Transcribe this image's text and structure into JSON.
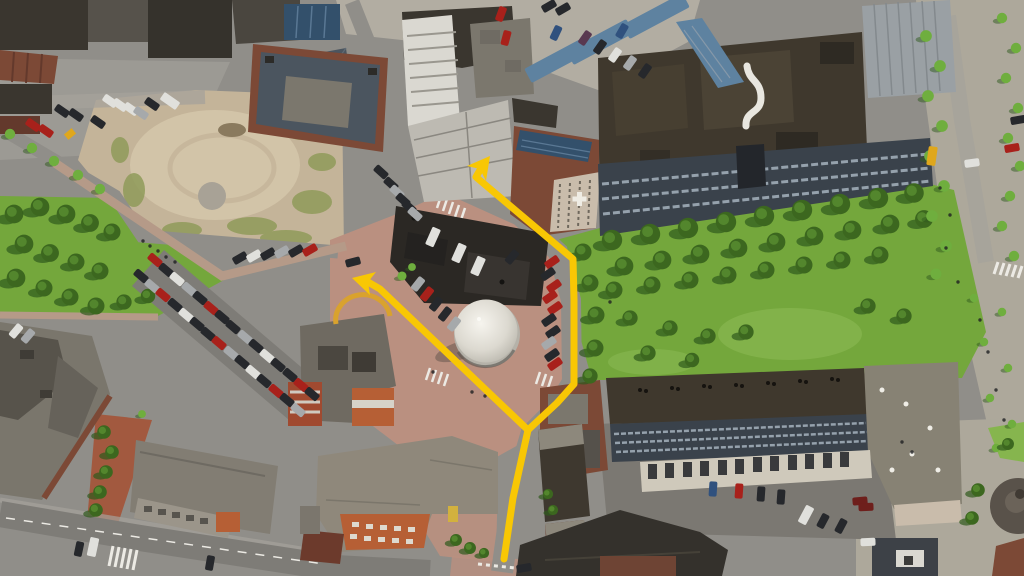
{
  "scene": {
    "title": "Oblique aerial photograph of a town centre with a yellow walking route marked by two arrows",
    "annotation_type": "route-arrows",
    "arrow_count": 2,
    "features": "construction site, lawn park with trees, round white pavilion, market hall, office complex, apartment blocks, tree rows, parking lots"
  },
  "colors": {
    "route": "#f8c704",
    "grass": "#74a73c",
    "grass-light": "#86b54e",
    "shade": "#2f5a1d",
    "tree": "#3c671f",
    "tree-light": "#6fae3e",
    "dirt": "#c4b499",
    "dirt-light": "#d8cbae",
    "weeds": "#909b5a",
    "plaza": "#ba9080",
    "path": "#b59a88",
    "path-red": "#a2593f",
    "road": "#908e89",
    "road-light": "#a5a29b",
    "asphalt": "#7e7c77",
    "concrete": "#b2ada2",
    "pavement": "#ada89b",
    "courtyard": "#7b7872",
    "marking": "#eceae4",
    "roof-black": "#2b2824",
    "roof-brown": "#3f382d",
    "roof-dark": "#3a362f",
    "roof-gray": "#7b776d",
    "roof-pale": "#8e887b",
    "roof-light": "#9aa0a4",
    "roof-slate": "#4b555f",
    "roof-blue": "#5e82a0",
    "solar": "#33506b",
    "brick": "#7c4936",
    "brick-dark": "#63392c",
    "orange": "#b65f35",
    "cream": "#c9bcab",
    "white-bldg": "#dad8d1",
    "glass": "#3a424b",
    "glass-light": "#95a1ac",
    "facade": "#bdbab2",
    "car-red": "#a8211b",
    "car-dark": "#26282c",
    "car-white": "#e0e0dc",
    "car-silver": "#a6a9ab",
    "car-blue": "#30517e",
    "car-purple": "#593850",
    "car-dkred": "#6e1f1c",
    "bus-yellow": "#dfa71c",
    "pavilion-shade": "#b5b2a9"
  },
  "route": {
    "stroke_width": "7",
    "stem_points": "504,559 513,498 528,430",
    "branch_ne_points": "528,430 557,403 574,384 574,300 573,259 476,177 480,170",
    "branch_w_points": "528,430 380,289 368,282",
    "arrowhead_ne_points": "490,156 486,181 480,169 467,166",
    "arrowhead_w_points": "352,278 376,272 368,282 370,295"
  }
}
